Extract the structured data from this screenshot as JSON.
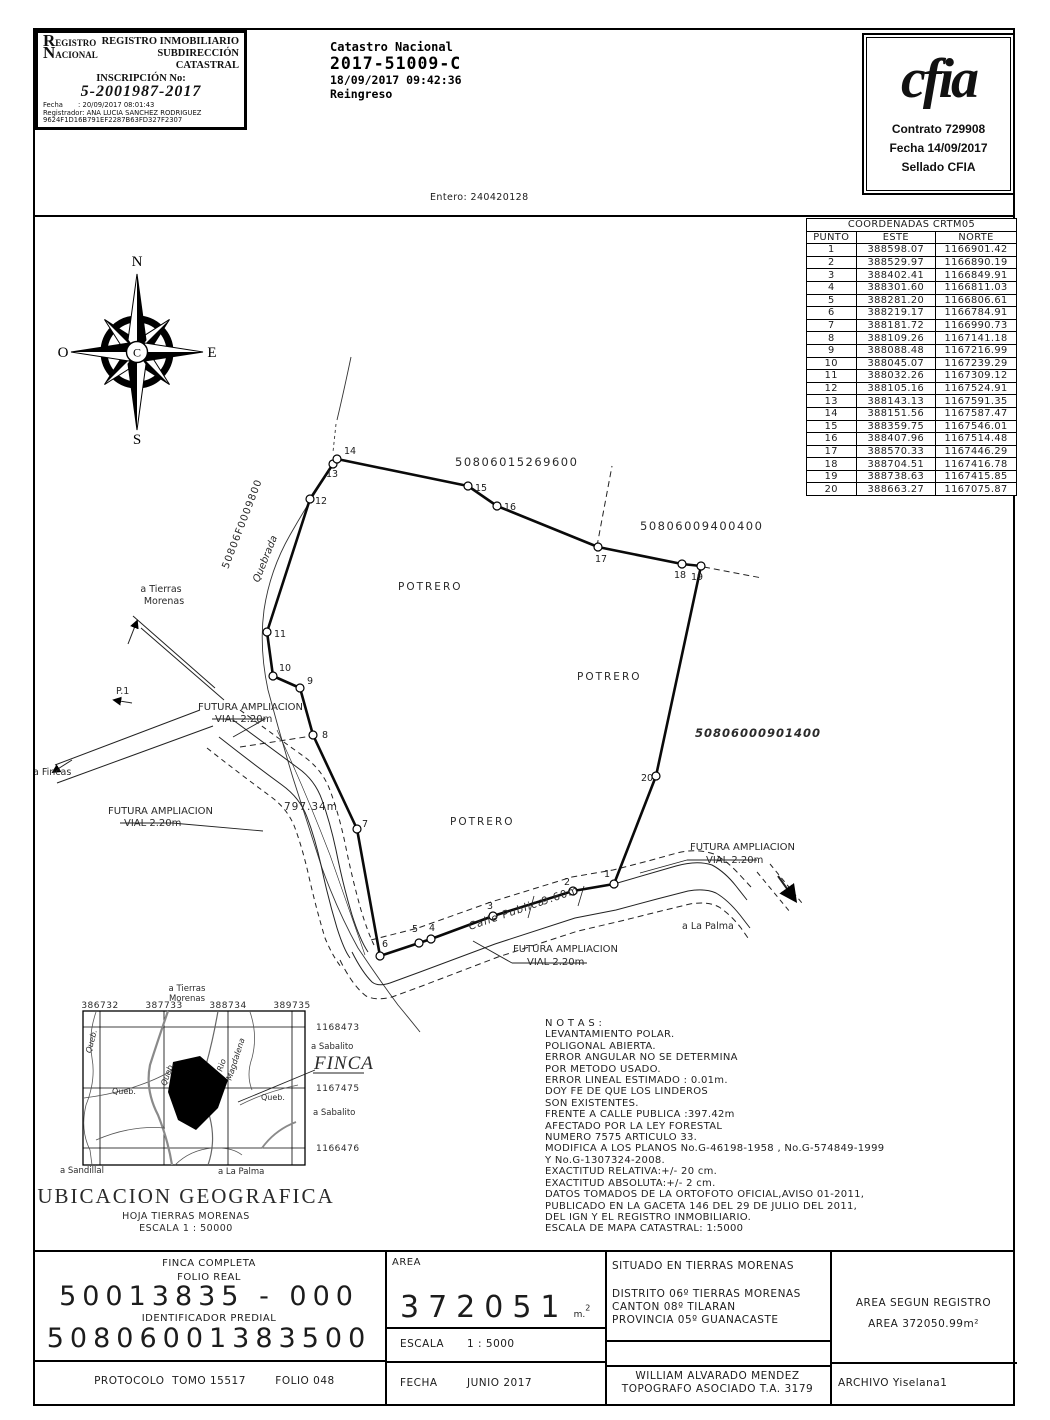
{
  "stamp": {
    "logo_big1": "R",
    "logo_rest1": "EGISTRO",
    "logo_big2": "N",
    "logo_rest2": "ACIONAL",
    "title1": "REGISTRO INMOBILIARIO",
    "title2": "SUBDIRECCIÓN",
    "title3": "CATASTRAL",
    "inscripcion_label": "INSCRIPCIÓN No:",
    "inscripcion_value": "5-2001987-2017",
    "fecha_line": "Fecha       : 20/09/2017 08:01:43",
    "registrador_line": "Registrador: ANA LUCIA SANCHEZ RODRIGUEZ",
    "hash_line": "9624F1D16B791EF2287B63FD327F2307"
  },
  "catastro": {
    "line1": "Catastro Nacional",
    "line2": "2017-51009-C",
    "line3": "18/09/2017 09:42:36",
    "line4": "Reingreso"
  },
  "cfia": {
    "logo": "cfia",
    "line1": "Contrato 729908",
    "line2": "Fecha 14/09/2017",
    "line3": "Sellado CFIA"
  },
  "entero": "Entero: 240420128",
  "coords": {
    "title": "COORDENADAS CRTM05",
    "headers": [
      "PUNTO",
      "ESTE",
      "NORTE"
    ],
    "rows": [
      [
        "1",
        "388598.07",
        "1166901.42"
      ],
      [
        "2",
        "388529.97",
        "1166890.19"
      ],
      [
        "3",
        "388402.41",
        "1166849.91"
      ],
      [
        "4",
        "388301.60",
        "1166811.03"
      ],
      [
        "5",
        "388281.20",
        "1166806.61"
      ],
      [
        "6",
        "388219.17",
        "1166784.91"
      ],
      [
        "7",
        "388181.72",
        "1166990.73"
      ],
      [
        "8",
        "388109.26",
        "1167141.18"
      ],
      [
        "9",
        "388088.48",
        "1167216.99"
      ],
      [
        "10",
        "388045.07",
        "1167239.29"
      ],
      [
        "11",
        "388032.26",
        "1167309.12"
      ],
      [
        "12",
        "388105.16",
        "1167524.91"
      ],
      [
        "13",
        "388143.13",
        "1167591.35"
      ],
      [
        "14",
        "388151.56",
        "1167587.47"
      ],
      [
        "15",
        "388359.75",
        "1167546.01"
      ],
      [
        "16",
        "388407.96",
        "1167514.48"
      ],
      [
        "17",
        "388570.33",
        "1167446.29"
      ],
      [
        "18",
        "388704.51",
        "1167416.78"
      ],
      [
        "19",
        "388738.63",
        "1167415.85"
      ],
      [
        "20",
        "388663.27",
        "1167075.87"
      ]
    ]
  },
  "compass": {
    "north": "N",
    "south": "S",
    "east": "E",
    "west": "O",
    "center": "C"
  },
  "map": {
    "parcel_north": "50806015269600",
    "parcel_ne": "50806009400400",
    "parcel_east": "50806000901400",
    "parcel_west": "50806F0009800",
    "potrero": "POTRERO",
    "quebrada": "Quebrada",
    "road_length": "797.34m",
    "road_width": "9.60m",
    "calle": "Calle Publica",
    "to_tierras1": "a Tierras",
    "to_tierras2": "Morenas",
    "to_fincas": "a Fincas",
    "to_palma": "a La Palma",
    "p1": "P.1",
    "futura1": "FUTURA AMPLIACION",
    "futura2": "VIAL 2.20m"
  },
  "minimap": {
    "xticks": [
      "386732",
      "387733",
      "388734",
      "389735"
    ],
    "yticks": [
      "1168473",
      "1167475",
      "1166476"
    ],
    "tierras1": "a Tierras",
    "tierras2": "Morenas",
    "sabalito": "a Sabalito",
    "sandillal": "a Sandillal",
    "palma": "a La Palma",
    "finca": "FINCA",
    "queb": "Queb.",
    "rio1": "Rio",
    "rio2": "Magdalena",
    "title": "UBICACION GEOGRAFICA",
    "hoja": "HOJA TIERRAS MORENAS",
    "escala": "ESCALA 1 : 50000"
  },
  "notas": {
    "text": "N O T A S :\nLEVANTAMIENTO POLAR.\nPOLIGONAL ABIERTA.\nERROR ANGULAR NO SE DETERMINA\nPOR METODO USADO.\nERROR LINEAL ESTIMADO : 0.01m.\nDOY FE DE QUE LOS LINDEROS\nSON EXISTENTES.\nFRENTE A CALLE PUBLICA :397.42m\nAFECTADO POR LA LEY FORESTAL\nNUMERO 7575 ARTICULO 33.\nMODIFICA A LOS PLANOS No.G-46198-1958 , No.G-574849-1999\nY No.G-1307324-2008.\nEXACTITUD RELATIVA:+/- 20 cm.\nEXACTITUD ABSOLUTA:+/- 2 cm.\nDATOS TOMADOS DE LA ORTOFOTO OFICIAL,AVISO 01-2011,\nPUBLICADO EN LA GACETA 146 DEL 29 DE JULIO DEL 2011,\nDEL IGN Y EL REGISTRO INMOBILIARIO.\nESCALA DE MAPA CATASTRAL: 1:5000"
  },
  "titleblock": {
    "finca_completa": "FINCA COMPLETA",
    "folio_real": "FOLIO REAL",
    "folio_num": "50013835 - 000",
    "ident_label": "IDENTIFICADOR PREDIAL",
    "ident_num": "50806001383500",
    "protocolo": "PROTOCOLO  TOMO 15517",
    "folio": "FOLIO 048",
    "area_label": "AREA",
    "area_value": "372051",
    "area_unit": "m.",
    "area_sup": "2",
    "escala_label": "ESCALA",
    "escala_value": "1 : 5000",
    "fecha_label": "FECHA",
    "fecha_value": "JUNIO 2017",
    "situado": "SITUADO EN TIERRAS MORENAS",
    "distrito": "DISTRITO 06º TIERRAS MORENAS",
    "canton": "CANTON 08º TILARAN",
    "provincia": "PROVINCIA 05º GUANACASTE",
    "topografo1": "WILLIAM ALVARADO MENDEZ",
    "topografo2": "TOPOGRAFO ASOCIADO T.A. 3179",
    "area_registro1": "AREA SEGUN REGISTRO",
    "area_registro2": "AREA 372050.99m²",
    "archivo": "ARCHIVO Yiselana1"
  }
}
